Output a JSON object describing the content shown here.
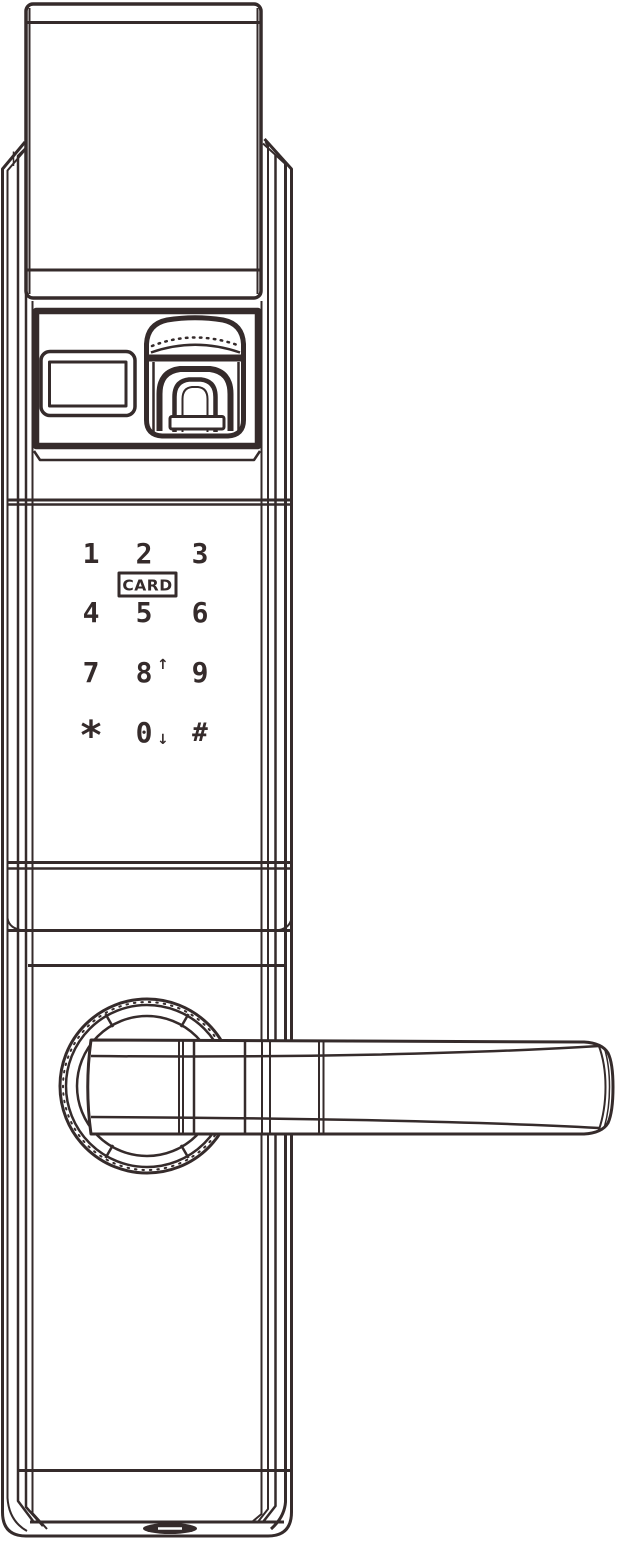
{
  "colors": {
    "line": "#352b2b",
    "background": "#ffffff"
  },
  "keypad": {
    "keys": [
      {
        "id": "key-1",
        "label": "1"
      },
      {
        "id": "key-2",
        "label": "2"
      },
      {
        "id": "key-3",
        "label": "3"
      },
      {
        "id": "key-4",
        "label": "4"
      },
      {
        "id": "key-5",
        "label": "5"
      },
      {
        "id": "key-6",
        "label": "6"
      },
      {
        "id": "key-7",
        "label": "7"
      },
      {
        "id": "key-8",
        "label": "8",
        "arrow": "↑"
      },
      {
        "id": "key-9",
        "label": "9"
      },
      {
        "id": "key-star",
        "label": "*"
      },
      {
        "id": "key-0",
        "label": "0",
        "arrow": "↓"
      },
      {
        "id": "key-hash",
        "label": "#"
      }
    ],
    "card_label": "CARD"
  },
  "icons": {
    "fingerprint_sensor": "fingerprint-sensor-icon",
    "display_window": "display-window",
    "card_reader": "card-reader-zone",
    "door_handle": "door-handle",
    "bottom_port": "bottom-port"
  }
}
